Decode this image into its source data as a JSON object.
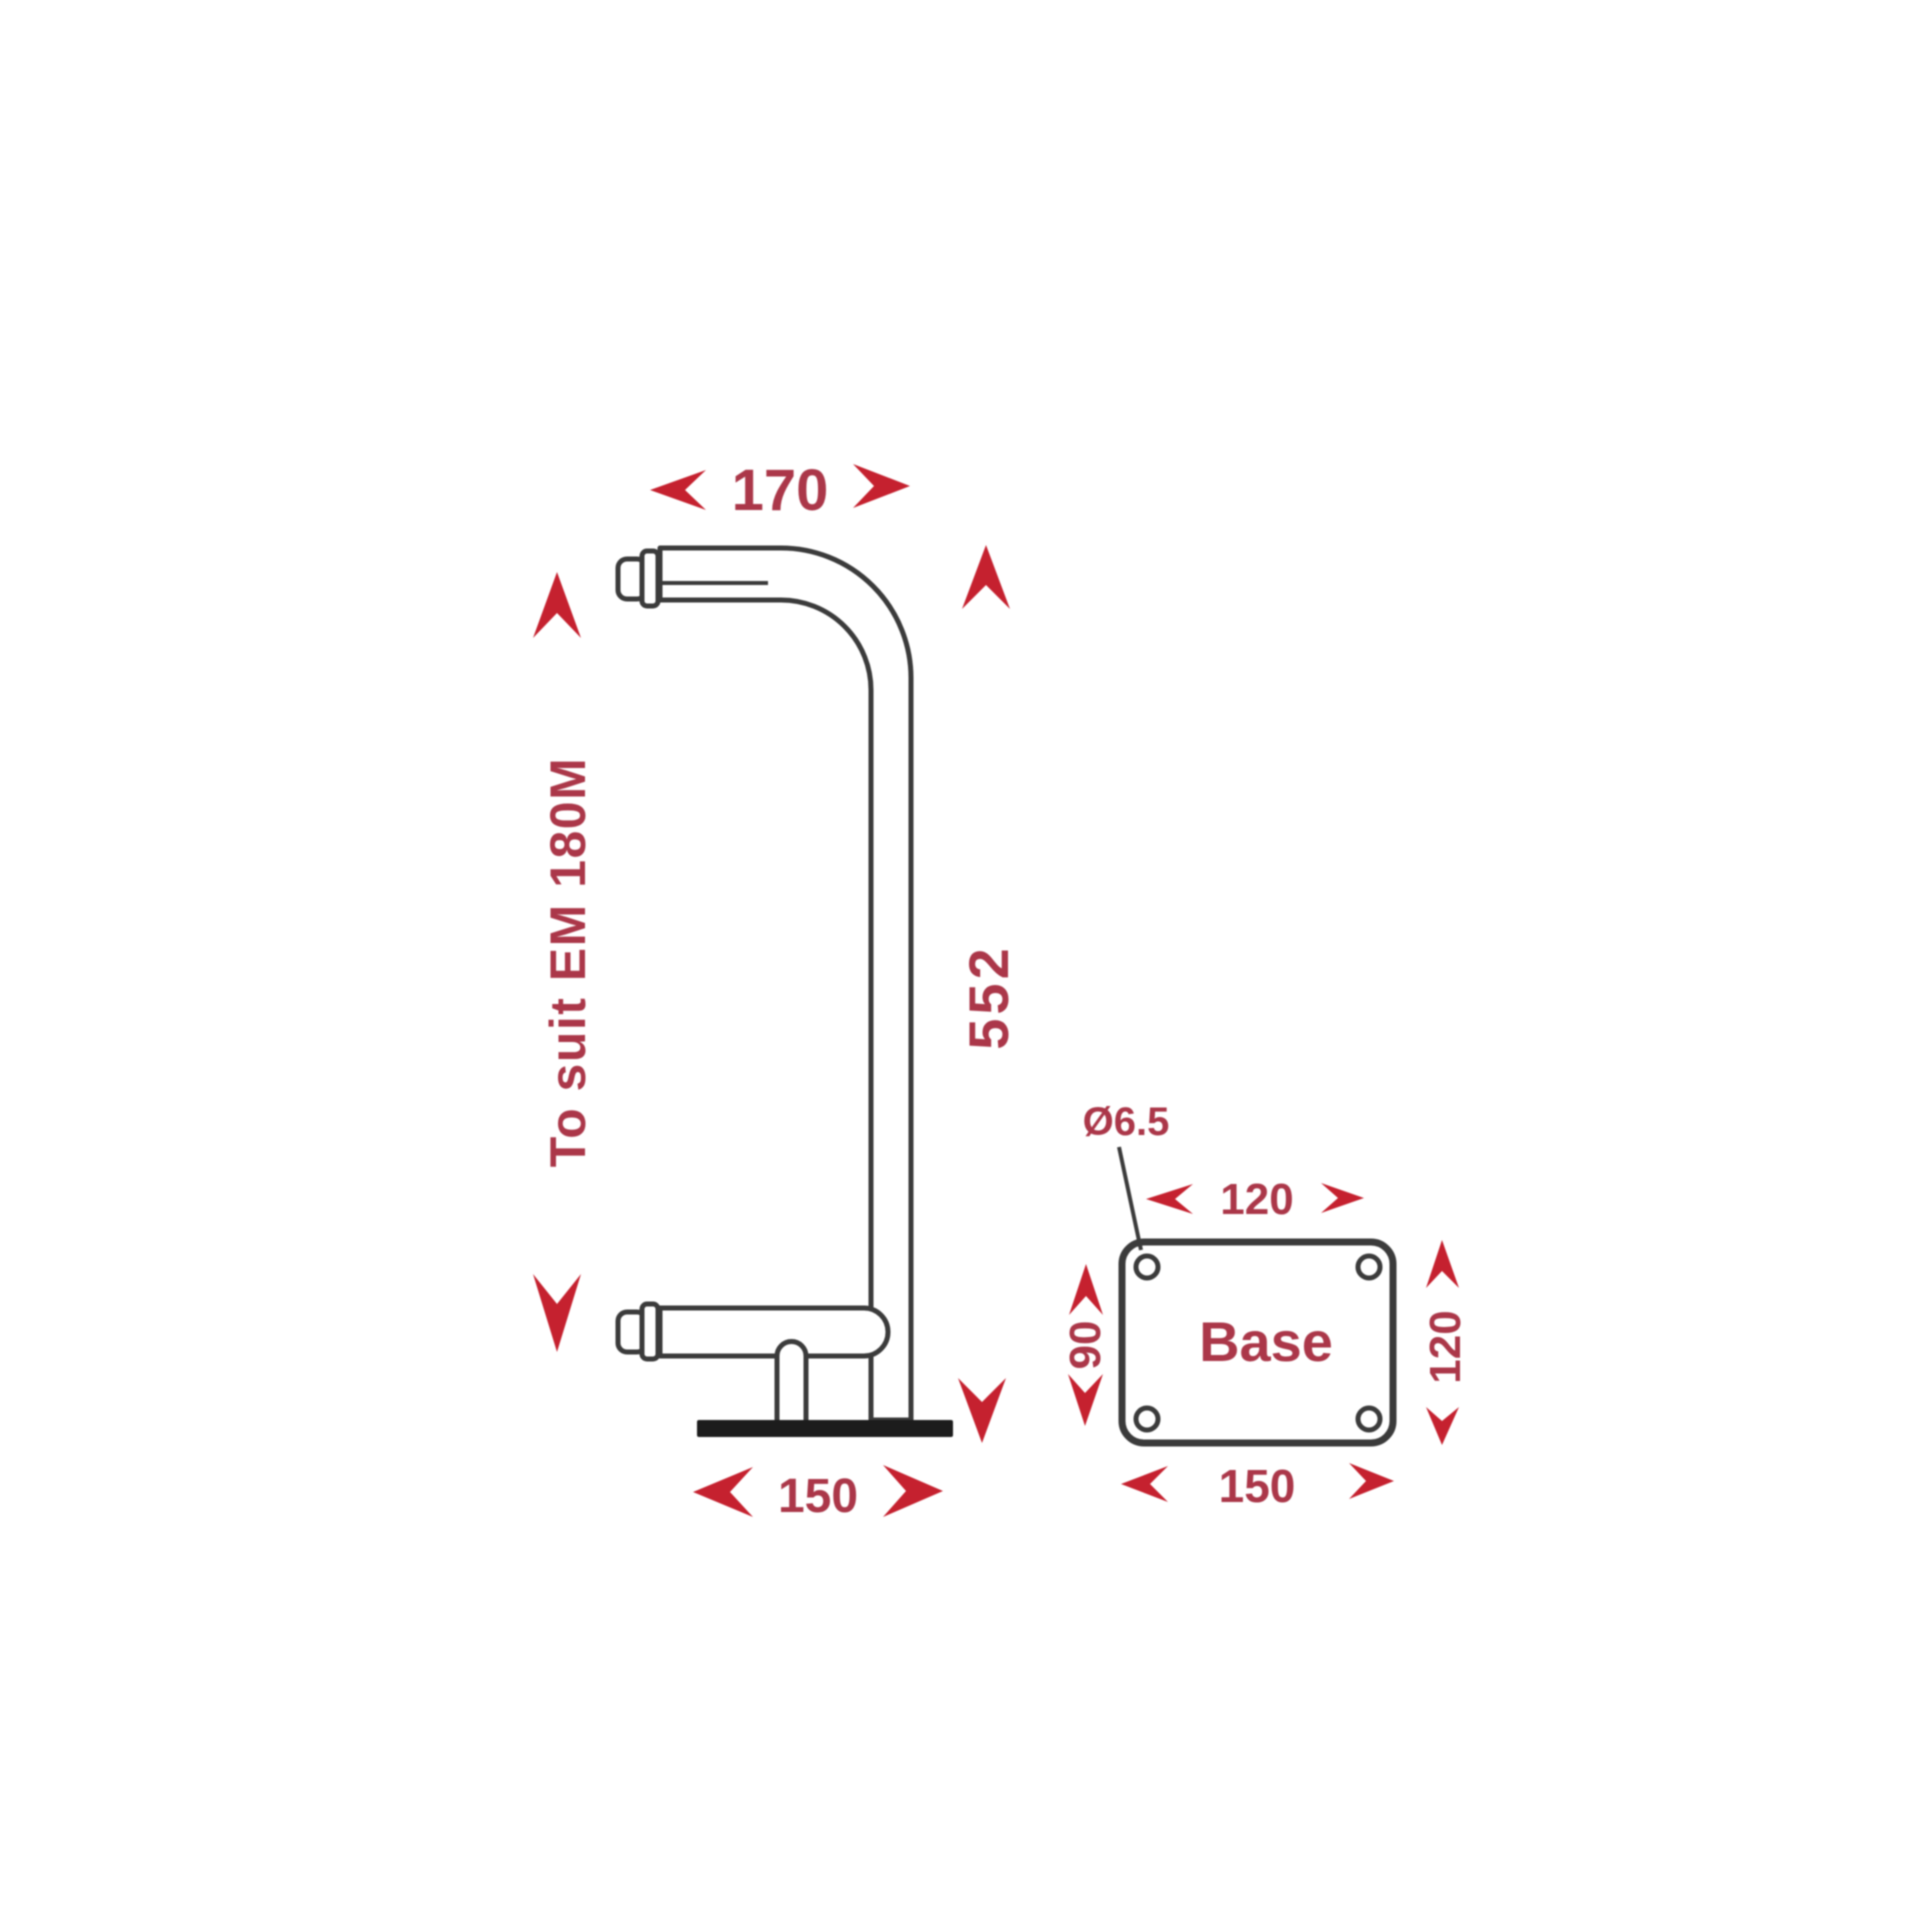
{
  "drawing_title": "Pole bracket dimension drawing",
  "elevation": {
    "top_width": "170",
    "suit_note": "To suit EM 180M",
    "height": "552",
    "base_width": "150"
  },
  "base_plan": {
    "hole_diameter": "Ø6.5",
    "top_width": "120",
    "left_depth": "90",
    "right_height": "120",
    "bottom_width": "150",
    "label": "Base"
  },
  "colors": {
    "dimension_text": "#ab3749",
    "arrow_red": "#c5212f",
    "line_dark": "#3b3b3b",
    "base_bar": "#1c1c1c",
    "background": "#ffffff"
  }
}
